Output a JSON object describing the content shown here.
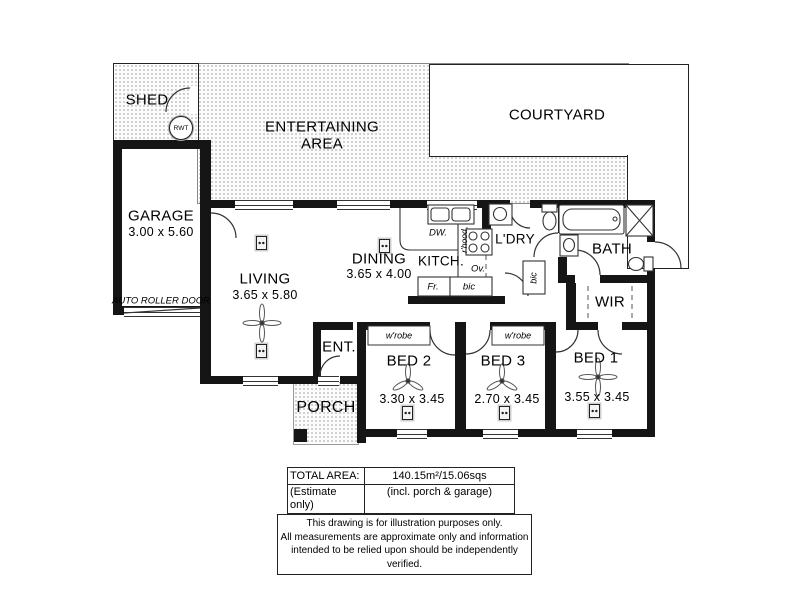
{
  "outdoor": {
    "shed": "SHED",
    "rwt": "RWT",
    "entertaining_line1": "ENTERTAINING",
    "entertaining_line2": "AREA",
    "courtyard": "COURTYARD",
    "porch": "PORCH",
    "auto_roller_door": "AUTO ROLLER DOOR"
  },
  "rooms": {
    "garage": {
      "name": "GARAGE",
      "dims": "3.00 x 5.60"
    },
    "living": {
      "name": "LIVING",
      "dims": "3.65 x 5.80"
    },
    "dining": {
      "name": "DINING",
      "dims": "3.65 x 4.00"
    },
    "kitchen": {
      "name": "KITCH."
    },
    "laundry": {
      "name": "L'DRY"
    },
    "bath": {
      "name": "BATH"
    },
    "wir": {
      "name": "WIR"
    },
    "entry": {
      "name": "ENT."
    },
    "bed2": {
      "name": "BED 2",
      "dims": "3.30 x 3.45"
    },
    "bed3": {
      "name": "BED 3",
      "dims": "2.70 x 3.45"
    },
    "bed1": {
      "name": "BED 1",
      "dims": "3.55 x 3.45"
    }
  },
  "kitchen_labels": {
    "dw": "DW.",
    "rhood": "r'hood",
    "ov": "Ov.",
    "fr": "Fr.",
    "bic": "bic"
  },
  "laundry_labels": {
    "bic": "bic"
  },
  "bedroom_labels": {
    "wrobe_bed2": "w'robe",
    "wrobe_bed3": "w'robe"
  },
  "summary": {
    "total_area_label": "TOTAL AREA:",
    "estimate_label": "(Estimate only)",
    "total_area_value": "140.15m²/15.06sqs",
    "total_area_note": "(incl. porch & garage)"
  },
  "disclaimer": {
    "line1": "This drawing is for illustration purposes only.",
    "line2": "All measurements are approximate only and information",
    "line3": "intended to be relied upon should be independently verified."
  },
  "colors": {
    "wall": "#151515",
    "line": "#333333",
    "paving_dot": "#c3c3c3"
  }
}
